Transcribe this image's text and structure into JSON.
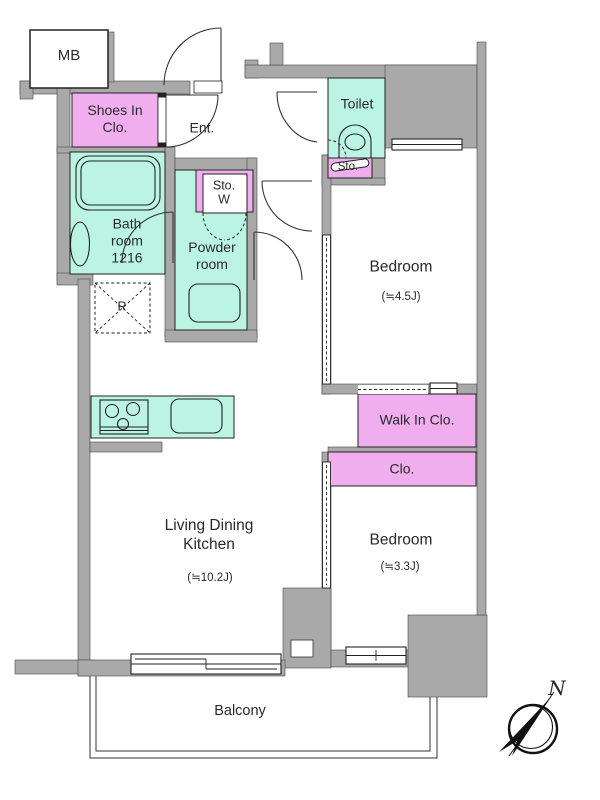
{
  "plan_title": "2-bedroom apartment floor plan",
  "rooms": {
    "mb": {
      "label": "MB"
    },
    "shoes_in_closet": {
      "label": "Shoes In\nClo."
    },
    "entrance": {
      "label": "Ent."
    },
    "toilet": {
      "label": "Toilet"
    },
    "toilet_storage": {
      "label": "Sto."
    },
    "storage_w": {
      "label": "Sto.\nW"
    },
    "bathroom": {
      "label": "Bath\nroom\n1216"
    },
    "powder_room": {
      "label": "Powder\nroom"
    },
    "refrigerator_space": {
      "label": "R"
    },
    "bedroom_1": {
      "label": "Bedroom",
      "area": "(≒4.5J)"
    },
    "walk_in_closet": {
      "label": "Walk In Clo."
    },
    "closet": {
      "label": "Clo."
    },
    "bedroom_2": {
      "label": "Bedroom",
      "area": "(≒3.3J)"
    },
    "ldk": {
      "label": "Living Dining\nKitchen",
      "area": "(≒10.2J)"
    },
    "balcony": {
      "label": "Balcony"
    }
  },
  "compass": {
    "north_label": "N"
  },
  "colors": {
    "wall": "#A9A9A9",
    "wet_room": "#BCF4E4",
    "closet": "#F0AEEF",
    "line": "#222222"
  }
}
